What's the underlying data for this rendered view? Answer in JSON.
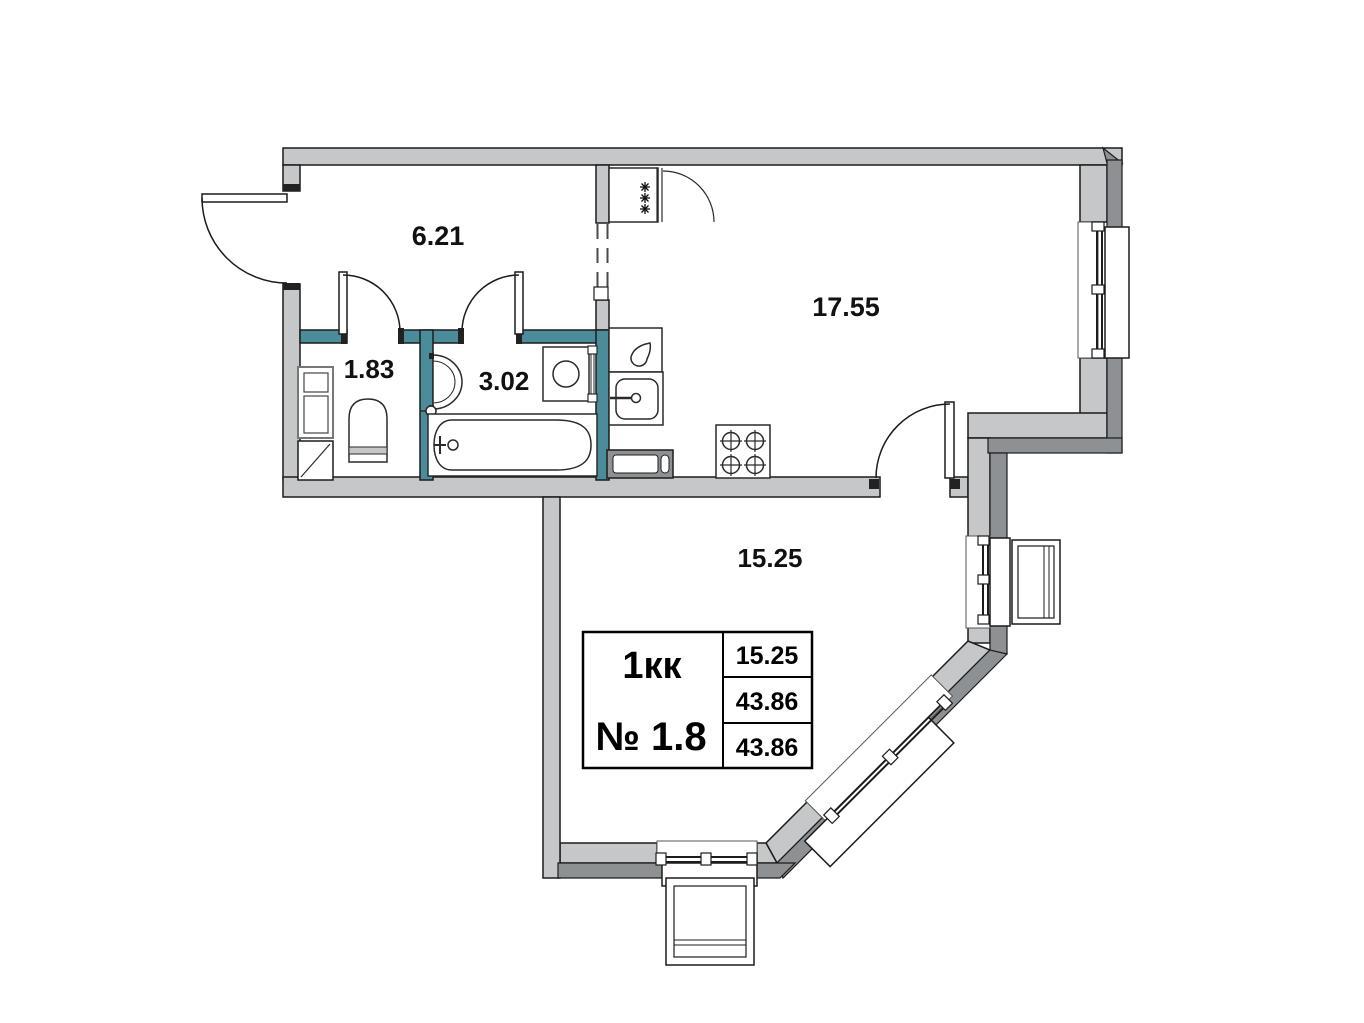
{
  "unit_card": {
    "type": "1кк",
    "number": "№ 1.8",
    "area_rows": [
      "15.25",
      "43.86",
      "43.86"
    ]
  },
  "rooms": {
    "hallway": {
      "area": "6.21"
    },
    "kitchen_living": {
      "area": "17.55"
    },
    "wc": {
      "area": "1.83"
    },
    "bathroom": {
      "area": "3.02"
    },
    "room": {
      "area": "15.25"
    }
  },
  "fixtures": [
    "fridge",
    "kitchen-counter",
    "kitchen-sink",
    "stove",
    "washing-machine",
    "bathtub",
    "wash-basin",
    "toilet",
    "vent-shaft",
    "entrance-door",
    "interior-doors",
    "windows",
    "balconies"
  ],
  "colors": {
    "wall_light": "#c6c7c9",
    "wall_dark": "#8e9193",
    "wet_zone_teal": "#4a8c99",
    "line": "#1c1c1c",
    "background": "#ffffff"
  }
}
